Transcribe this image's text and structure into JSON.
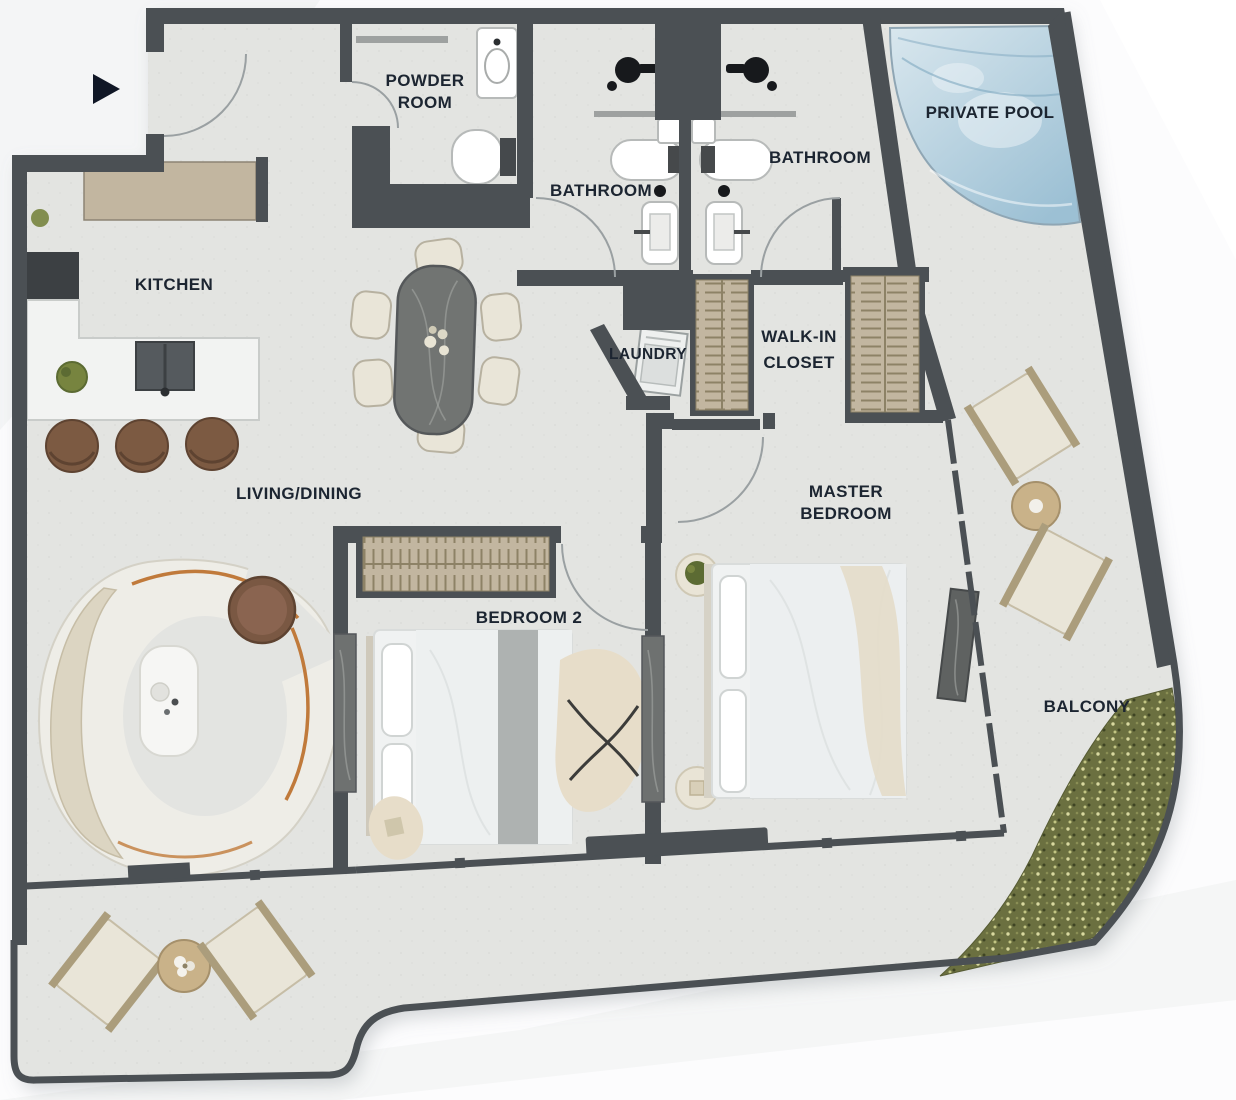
{
  "meta": {
    "type": "apartment-floor-plan",
    "view": "top-down"
  },
  "colors": {
    "bg": "#fcfcfd",
    "streak": "#edeff0",
    "floor": "#e3e4e1",
    "wall": "#4b5054",
    "label": "#1c2531",
    "accent": "#101726",
    "arc": "#9aa0a2",
    "tan": "#c2b6a0",
    "slat": "#8d8266",
    "wood": "#7c5a42",
    "wood_dark": "#5e4331",
    "cream": "#e9e5d8",
    "frame": "#ab9d7c",
    "rattan": "#c9b289",
    "white_f": "#f2f3f2",
    "stroke_light": "#c9ccca",
    "pool_light": "#d9e7ee",
    "pool_deep": "#9cc0d4",
    "pool_line": "#8fa6b4",
    "green": "#6b7040",
    "plant": "#77843f",
    "marble": "#717472",
    "panel": "#6e7170",
    "blanket": "#a6abaa",
    "rug": "#e7ddc9",
    "metal": "#17191c",
    "orange": "#c07a3b"
  },
  "icons": {
    "entrance": "triangle-right-arrow"
  },
  "labels": {
    "powder_room": {
      "line1": "POWDER",
      "line2": "ROOM"
    },
    "bathroom_left": {
      "line1": "BATHROOM"
    },
    "bathroom_right": {
      "line1": "BATHROOM"
    },
    "private_pool": {
      "line1": "PRIVATE POOL"
    },
    "kitchen": {
      "line1": "KITCHEN"
    },
    "laundry": {
      "line1": "LAUNDRY"
    },
    "walk_in_closet": {
      "line1": "WALK-IN",
      "line2": "CLOSET"
    },
    "living_dining": {
      "line1": "LIVING/DINING"
    },
    "master_bedroom": {
      "line1": "MASTER",
      "line2": "BEDROOM"
    },
    "bedroom_2": {
      "line1": "BEDROOM 2"
    },
    "balcony": {
      "line1": "BALCONY"
    }
  }
}
